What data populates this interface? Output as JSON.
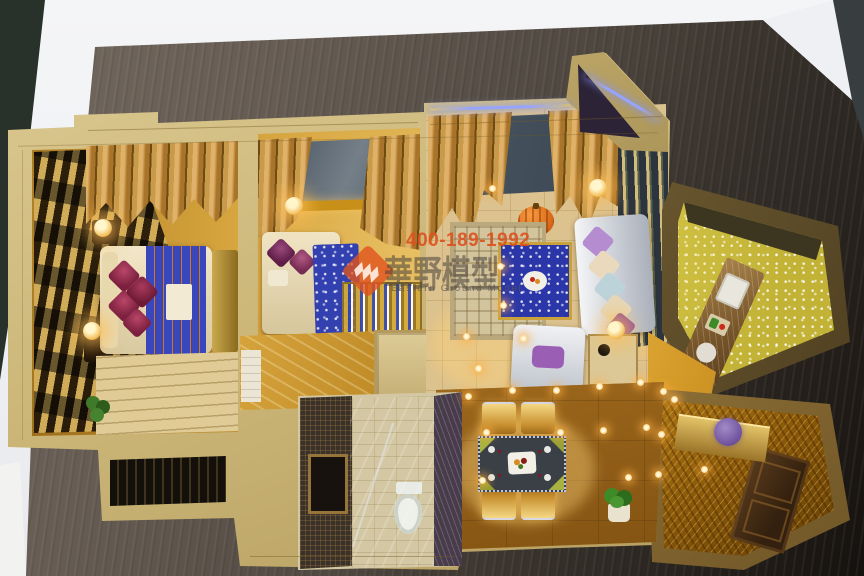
{
  "watermark": {
    "phone": "400-189-1992",
    "brand_cn": "華野模型",
    "brand_en": "Eastern Ground Model"
  },
  "palette": {
    "backdrop_wall": "#f1f2f5",
    "side_trim": "#28322b",
    "table_wood_light": "#6e645c",
    "table_wood_dark": "#17120f",
    "model_wall": "#cdb87a",
    "floor_gold": "#d9a83c",
    "curtain_gold": "#c79440",
    "window_glass": "#3c4a58",
    "led_blue": "#96a4ff",
    "ceiling_light": "#ffd98c",
    "pillow_maroon": "#8c2347",
    "pillow_purple": "#8a4a9e",
    "sofa_crystal": "#e3e5ea",
    "coffee_table_blue": "#2b36a8",
    "dining_table_top": "#3a4046",
    "door_brown": "#402a14",
    "kitchen_sparkle": "#cfc23e",
    "entry_foil": "#d8a830"
  },
  "lights": {
    "ceiling": [
      [
        468,
        396
      ],
      [
        512,
        390
      ],
      [
        556,
        390
      ],
      [
        599,
        386
      ],
      [
        640,
        382
      ],
      [
        486,
        432
      ],
      [
        560,
        432
      ],
      [
        603,
        430
      ],
      [
        646,
        427
      ],
      [
        482,
        480
      ],
      [
        628,
        477
      ],
      [
        663,
        391
      ],
      [
        674,
        399
      ],
      [
        661,
        434
      ],
      [
        704,
        469
      ],
      [
        658,
        474
      ],
      [
        492,
        188
      ],
      [
        500,
        266
      ],
      [
        503,
        305
      ],
      [
        466,
        336
      ],
      [
        523,
        338
      ],
      [
        478,
        368
      ]
    ],
    "lamps": [
      [
        103,
        228
      ],
      [
        92,
        331
      ],
      [
        294,
        206
      ],
      [
        598,
        188
      ],
      [
        616,
        330
      ]
    ]
  },
  "sofa_pillow_colors": [
    "#b48ccf",
    "#ead9bd",
    "#bcd3da",
    "#e6d7b8",
    "#8a4a9e"
  ]
}
